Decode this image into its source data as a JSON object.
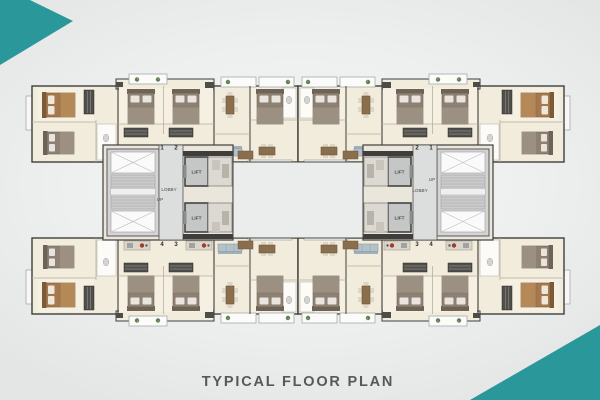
{
  "title": "TYPICAL FLOOR PLAN",
  "colors": {
    "accent_teal": "#2a989a",
    "background": "#eeefef",
    "floor_cream": "#f2ecdd",
    "wall_dark": "#3f3e3c",
    "core_gray": "#d6d6d6",
    "title_text": "#57585a"
  },
  "plan": {
    "left_core": {
      "lift_top": "LIFT",
      "lift_bottom": "LIFT",
      "lobby": "LOBBY",
      "up": "UP",
      "unit_top_left": "1",
      "unit_top_right": "2",
      "unit_bottom_left": "4",
      "unit_bottom_right": "3"
    },
    "right_core": {
      "lift_top": "LIFT",
      "lift_bottom": "LIFT",
      "lobby": "LOBBY",
      "up": "UP",
      "unit_top_left": "2",
      "unit_top_right": "1",
      "unit_bottom_left": "3",
      "unit_bottom_right": "4"
    }
  }
}
